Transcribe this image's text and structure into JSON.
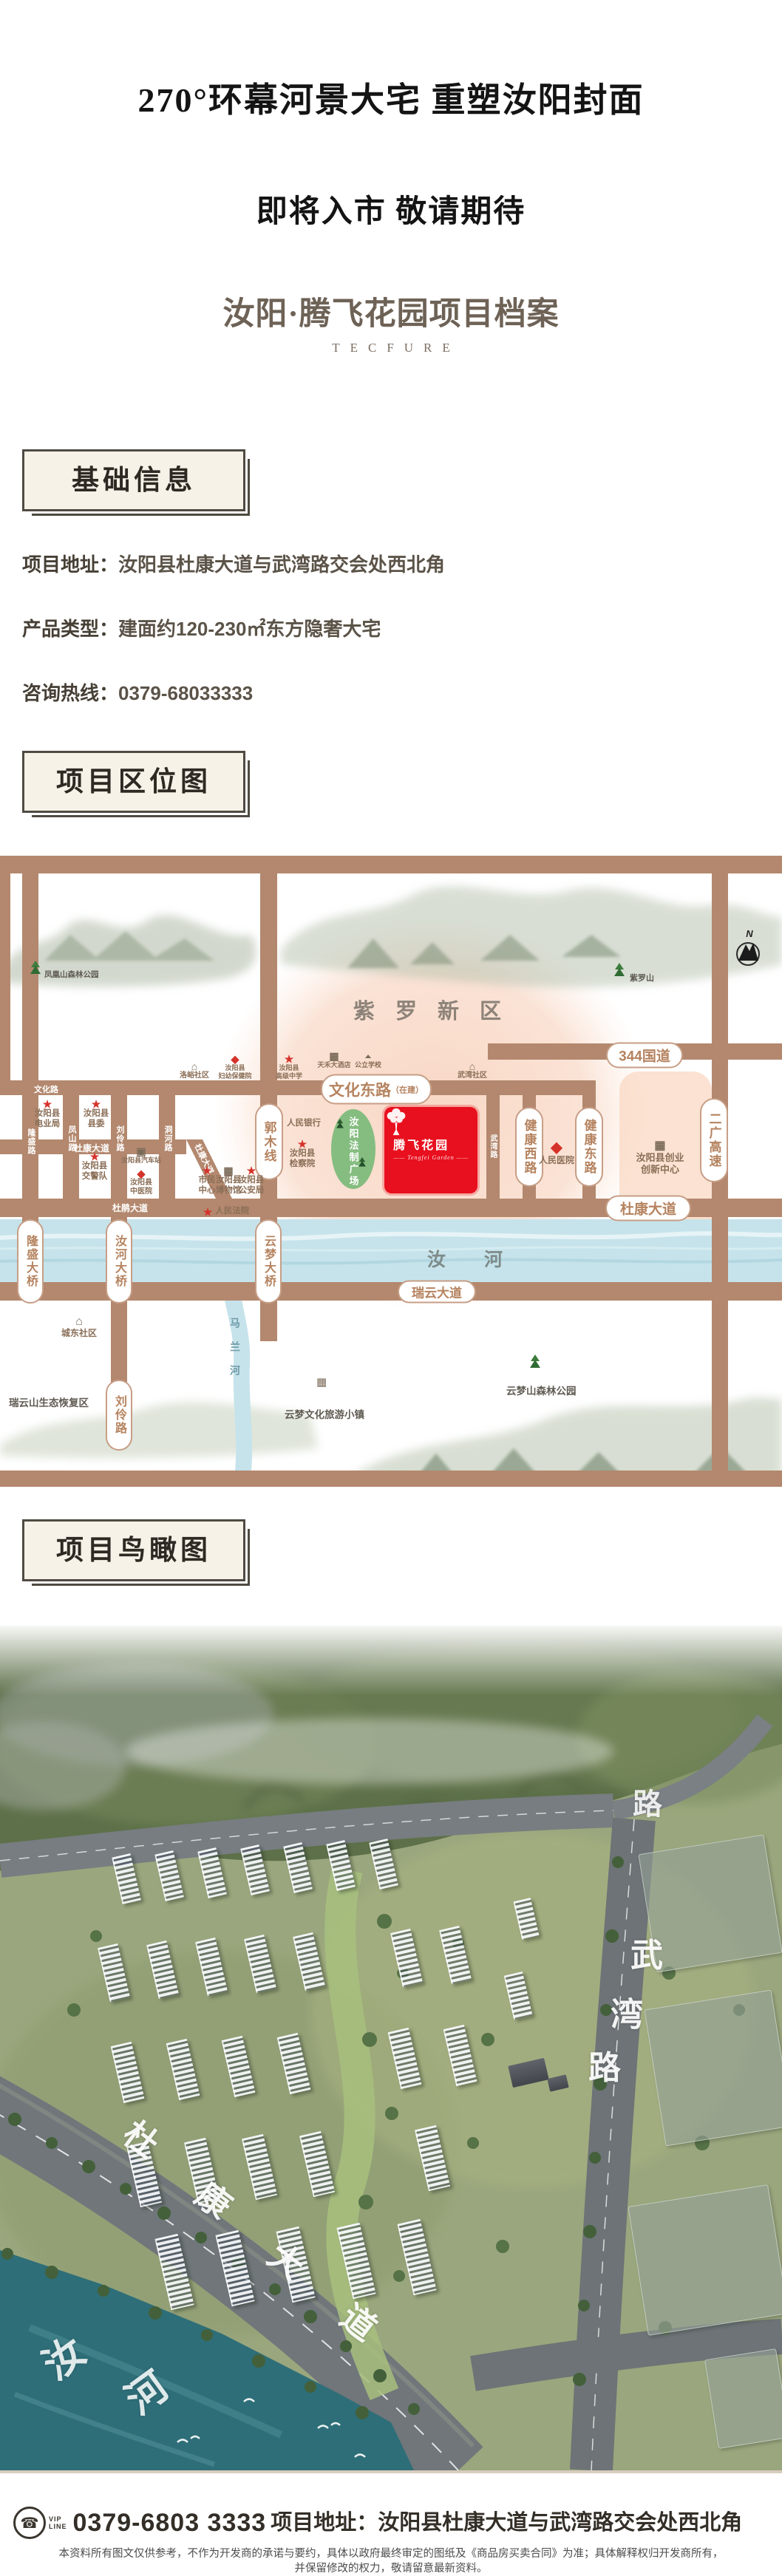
{
  "hero": {
    "title": "270°环幕河景大宅 重塑汝阳封面",
    "subtitle": "即将入市 敬请期待",
    "project_line": "汝阳·腾飞花园项目档案",
    "brand_en": "TECFURE"
  },
  "sections": {
    "basic_info": "基础信息",
    "location_map": "项目区位图",
    "aerial_view": "项目鸟瞰图"
  },
  "basic_info": {
    "rows": [
      {
        "label": "项目地址：",
        "value": "汝阳县杜康大道与武湾路交会处西北角"
      },
      {
        "label": "产品类型：",
        "value": "建面约120-230㎡东方隐奢大宅"
      },
      {
        "label": "咨询热线：",
        "value": "0379-68033333"
      }
    ]
  },
  "colors": {
    "brand_red": "#e8101e",
    "road_brown": "#b3886e",
    "pill_text": "#b5835f",
    "star_red": "#d5322a",
    "river_blue": "#c6e3eb",
    "header_cream": "#f7f2e8"
  },
  "icon_glyphs": {
    "star": "★",
    "diamond": "◆",
    "house": "⌂",
    "building": "▦",
    "bus": "▣",
    "school": "▲",
    "phone": "☎"
  },
  "map": {
    "district": "紫罗新区",
    "compass": "N",
    "river_main": "汝河",
    "river_branch": "马兰河",
    "project": {
      "name": "腾飞花园",
      "sub": "—— Tengfei Garden ——"
    },
    "pills": [
      {
        "t": "文化东路",
        "s": "（在建）"
      },
      {
        "t": "344国道"
      },
      {
        "t": "杜康大道"
      },
      {
        "t": "瑞云大道"
      },
      {
        "t": "郭木线"
      },
      {
        "t": "健康西路"
      },
      {
        "t": "健康东路"
      },
      {
        "t": "二广高速"
      },
      {
        "t": "隆盛大桥"
      },
      {
        "t": "汝河大桥"
      },
      {
        "t": "云梦大桥"
      },
      {
        "t": "刘伶路"
      }
    ],
    "streets": [
      "文化路",
      "杜康大道",
      "杜鹃大道",
      "隆盛路",
      "凤山路",
      "刘伶路",
      "洞河路",
      "武湾路",
      "杜康大道"
    ],
    "pois": [
      {
        "icon": "star",
        "l1": "汝阳县",
        "l2": "电业局"
      },
      {
        "icon": "star",
        "l1": "汝阳县",
        "l2": "县委"
      },
      {
        "icon": "star",
        "l1": "汝阳县",
        "l2": "交警队"
      },
      {
        "icon": "bus",
        "l1": "汝阳县汽车站"
      },
      {
        "icon": "diamond",
        "l1": "汝阳县",
        "l2": "中医院"
      },
      {
        "icon": "star",
        "l1": "市民",
        "l2": "中心"
      },
      {
        "icon": "building",
        "l1": "汝阳县",
        "l2": "博物馆"
      },
      {
        "icon": "star",
        "l1": "汝阳县",
        "l2": "公安局"
      },
      {
        "icon": "star",
        "l1": "人民法院"
      },
      {
        "icon": "none",
        "l1": "人民银行"
      },
      {
        "icon": "star",
        "l1": "汝阳县",
        "l2": "检察院"
      },
      {
        "icon": "house",
        "l1": "洛峪社区"
      },
      {
        "icon": "diamond",
        "l1": "汝阳县",
        "l2": "妇幼保健院"
      },
      {
        "icon": "star",
        "l1": "汝阳县",
        "l2": "高级中学"
      },
      {
        "icon": "building",
        "l1": "天禾大酒店"
      },
      {
        "icon": "school",
        "l1": "公立学校"
      },
      {
        "icon": "house",
        "l1": "武湾社区"
      },
      {
        "icon": "diamond",
        "l1": "人民医院"
      },
      {
        "icon": "building",
        "l1": "汝阳县创业",
        "l2": "创新中心"
      },
      {
        "icon": "house",
        "l1": "城东社区"
      }
    ],
    "parks": [
      {
        "t": "凤凰山森林公园"
      },
      {
        "t": "紫罗山"
      },
      {
        "t": "云梦山森林公园"
      },
      {
        "t": "云梦文化旅游小镇"
      },
      {
        "t": "瑞云山生态恢复区"
      },
      {
        "t": "汝阳法制广场"
      }
    ]
  },
  "aerial": {
    "wuwan": [
      "武",
      "湾",
      "路"
    ],
    "dukang": [
      "杜",
      "康",
      "大",
      "道"
    ],
    "ruhe": [
      "汝",
      "河"
    ],
    "partial_road": "路"
  },
  "footer": {
    "vip1": "VIP",
    "vip2": "LINE",
    "phone": "0379-6803 3333",
    "address_label": "项目地址：",
    "address": "汝阳县杜康大道与武湾路交会处西北角",
    "disclaimer1": "本资料所有图文仅供参考，不作为开发商的承诺与要约，具体以政府最终审定的图纸及《商品房买卖合同》为准；具体解释权归开发商所有，",
    "disclaimer2": "并保留修改的权力，敬请留意最新资料。"
  }
}
